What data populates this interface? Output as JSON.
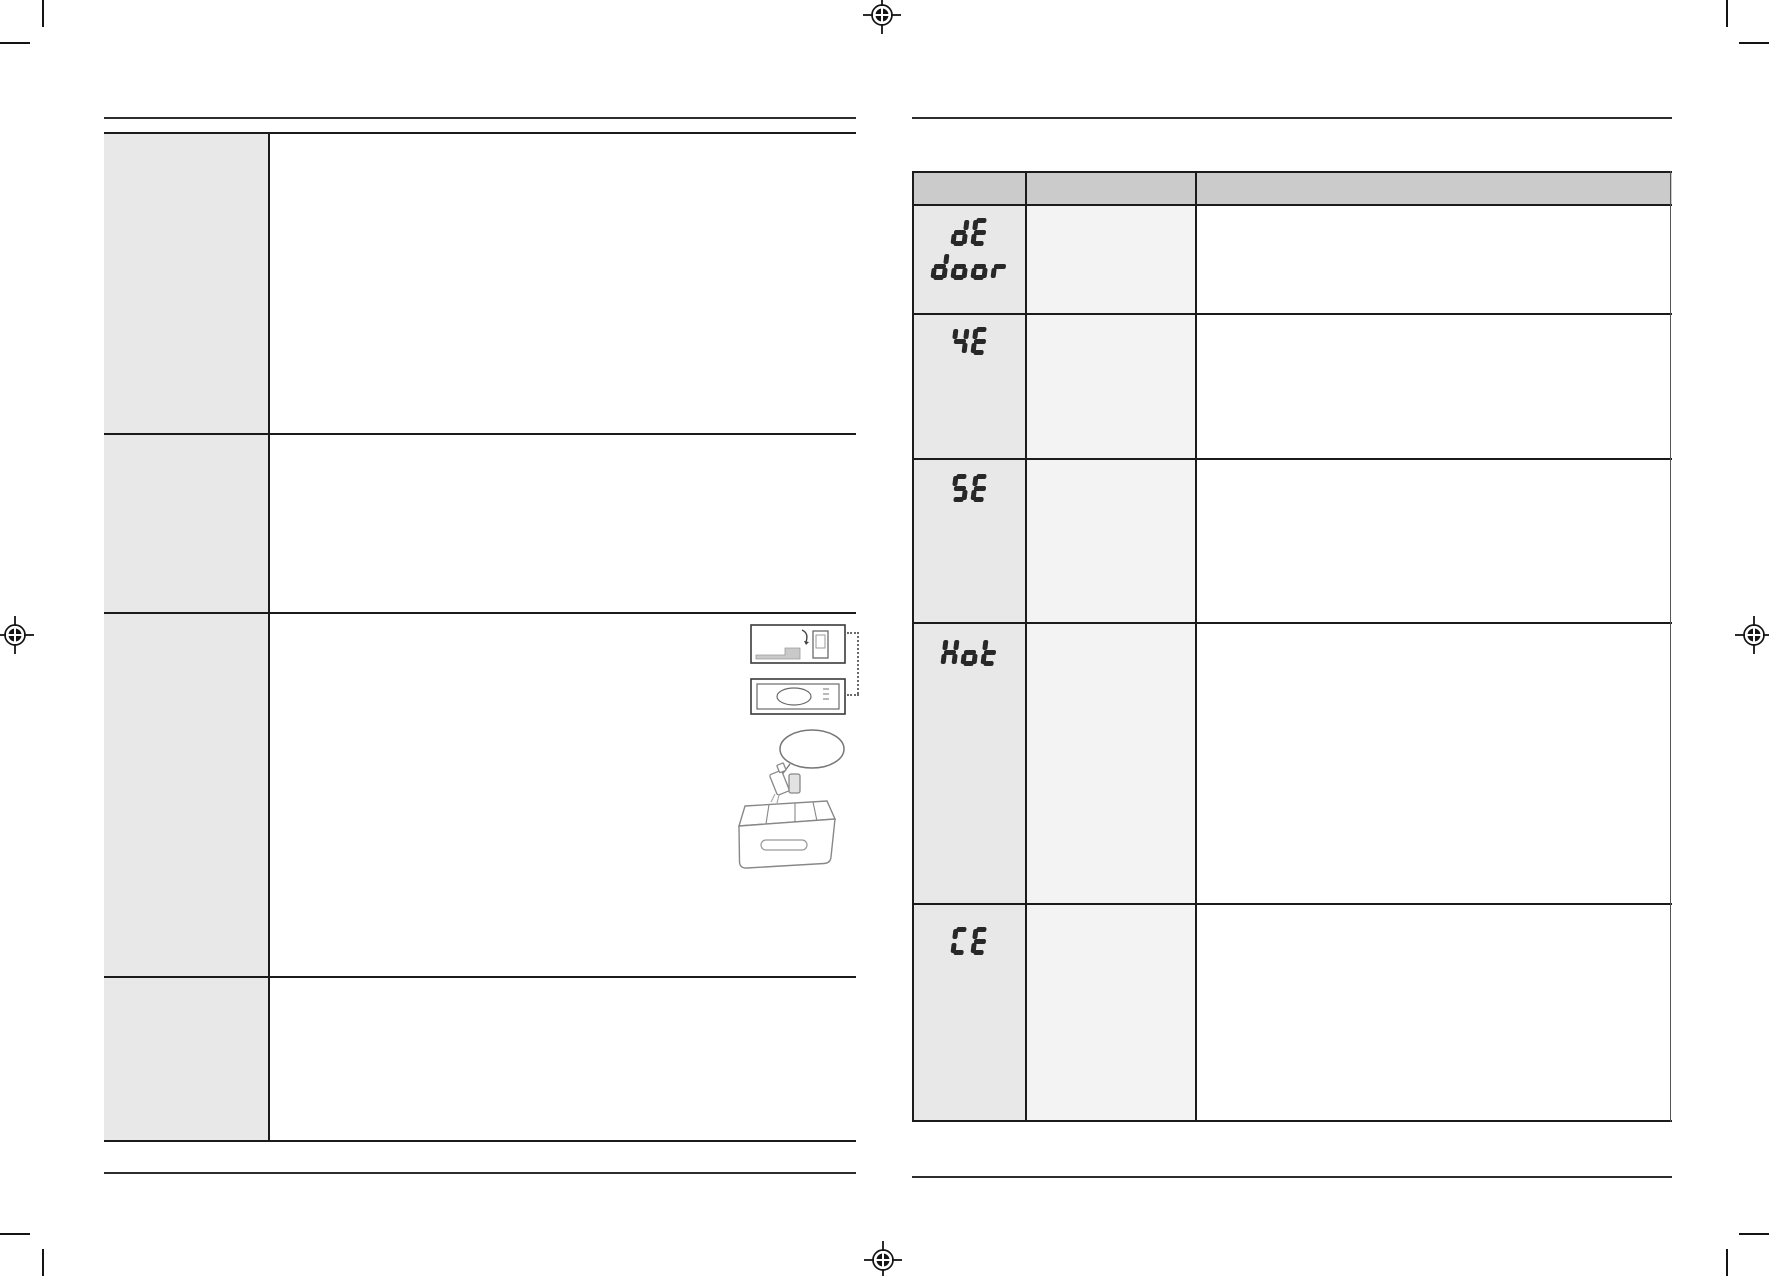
{
  "document": {
    "kind": "appliance-manual-troubleshooting-spread",
    "background": "#ffffff"
  },
  "colors": {
    "table_line": "#1b1b1b",
    "thin_rule": "#2d2d2d",
    "header_fill": "#cbcbcb",
    "code_column_fill": "#e8e8e8",
    "middle_column_fill": "#f3f3f3",
    "left_label_column_fill": "#e8e8e8",
    "glyph_color": "#282828",
    "illustration_stroke": "#777777"
  },
  "left_page": {
    "label_cells": [
      "",
      "",
      "",
      ""
    ],
    "content_cells": [
      "",
      "",
      "",
      ""
    ],
    "illustrations": [
      "washer-install-side-thumbnail",
      "washer-front-panel-thumbnail",
      "detergent-drawer-pouring-illustration"
    ]
  },
  "right_page": {
    "error_code_table": {
      "header_cells": [
        "",
        "",
        ""
      ],
      "rows": [
        {
          "code": "dE door",
          "code_lines": [
            "dE",
            "door"
          ],
          "cells": [
            "",
            ""
          ]
        },
        {
          "code": "4E",
          "code_lines": [
            "4E"
          ],
          "cells": [
            "",
            ""
          ]
        },
        {
          "code": "5E",
          "code_lines": [
            "5E"
          ],
          "cells": [
            "",
            ""
          ]
        },
        {
          "code": "Hot",
          "code_lines": [
            "Hot"
          ],
          "cells": [
            "",
            ""
          ]
        },
        {
          "code": "CE",
          "code_lines": [
            "CE"
          ],
          "cells": [
            "",
            ""
          ]
        }
      ]
    }
  },
  "print_marks": {
    "registration_targets": 4,
    "corner_crop_marks": 4
  }
}
